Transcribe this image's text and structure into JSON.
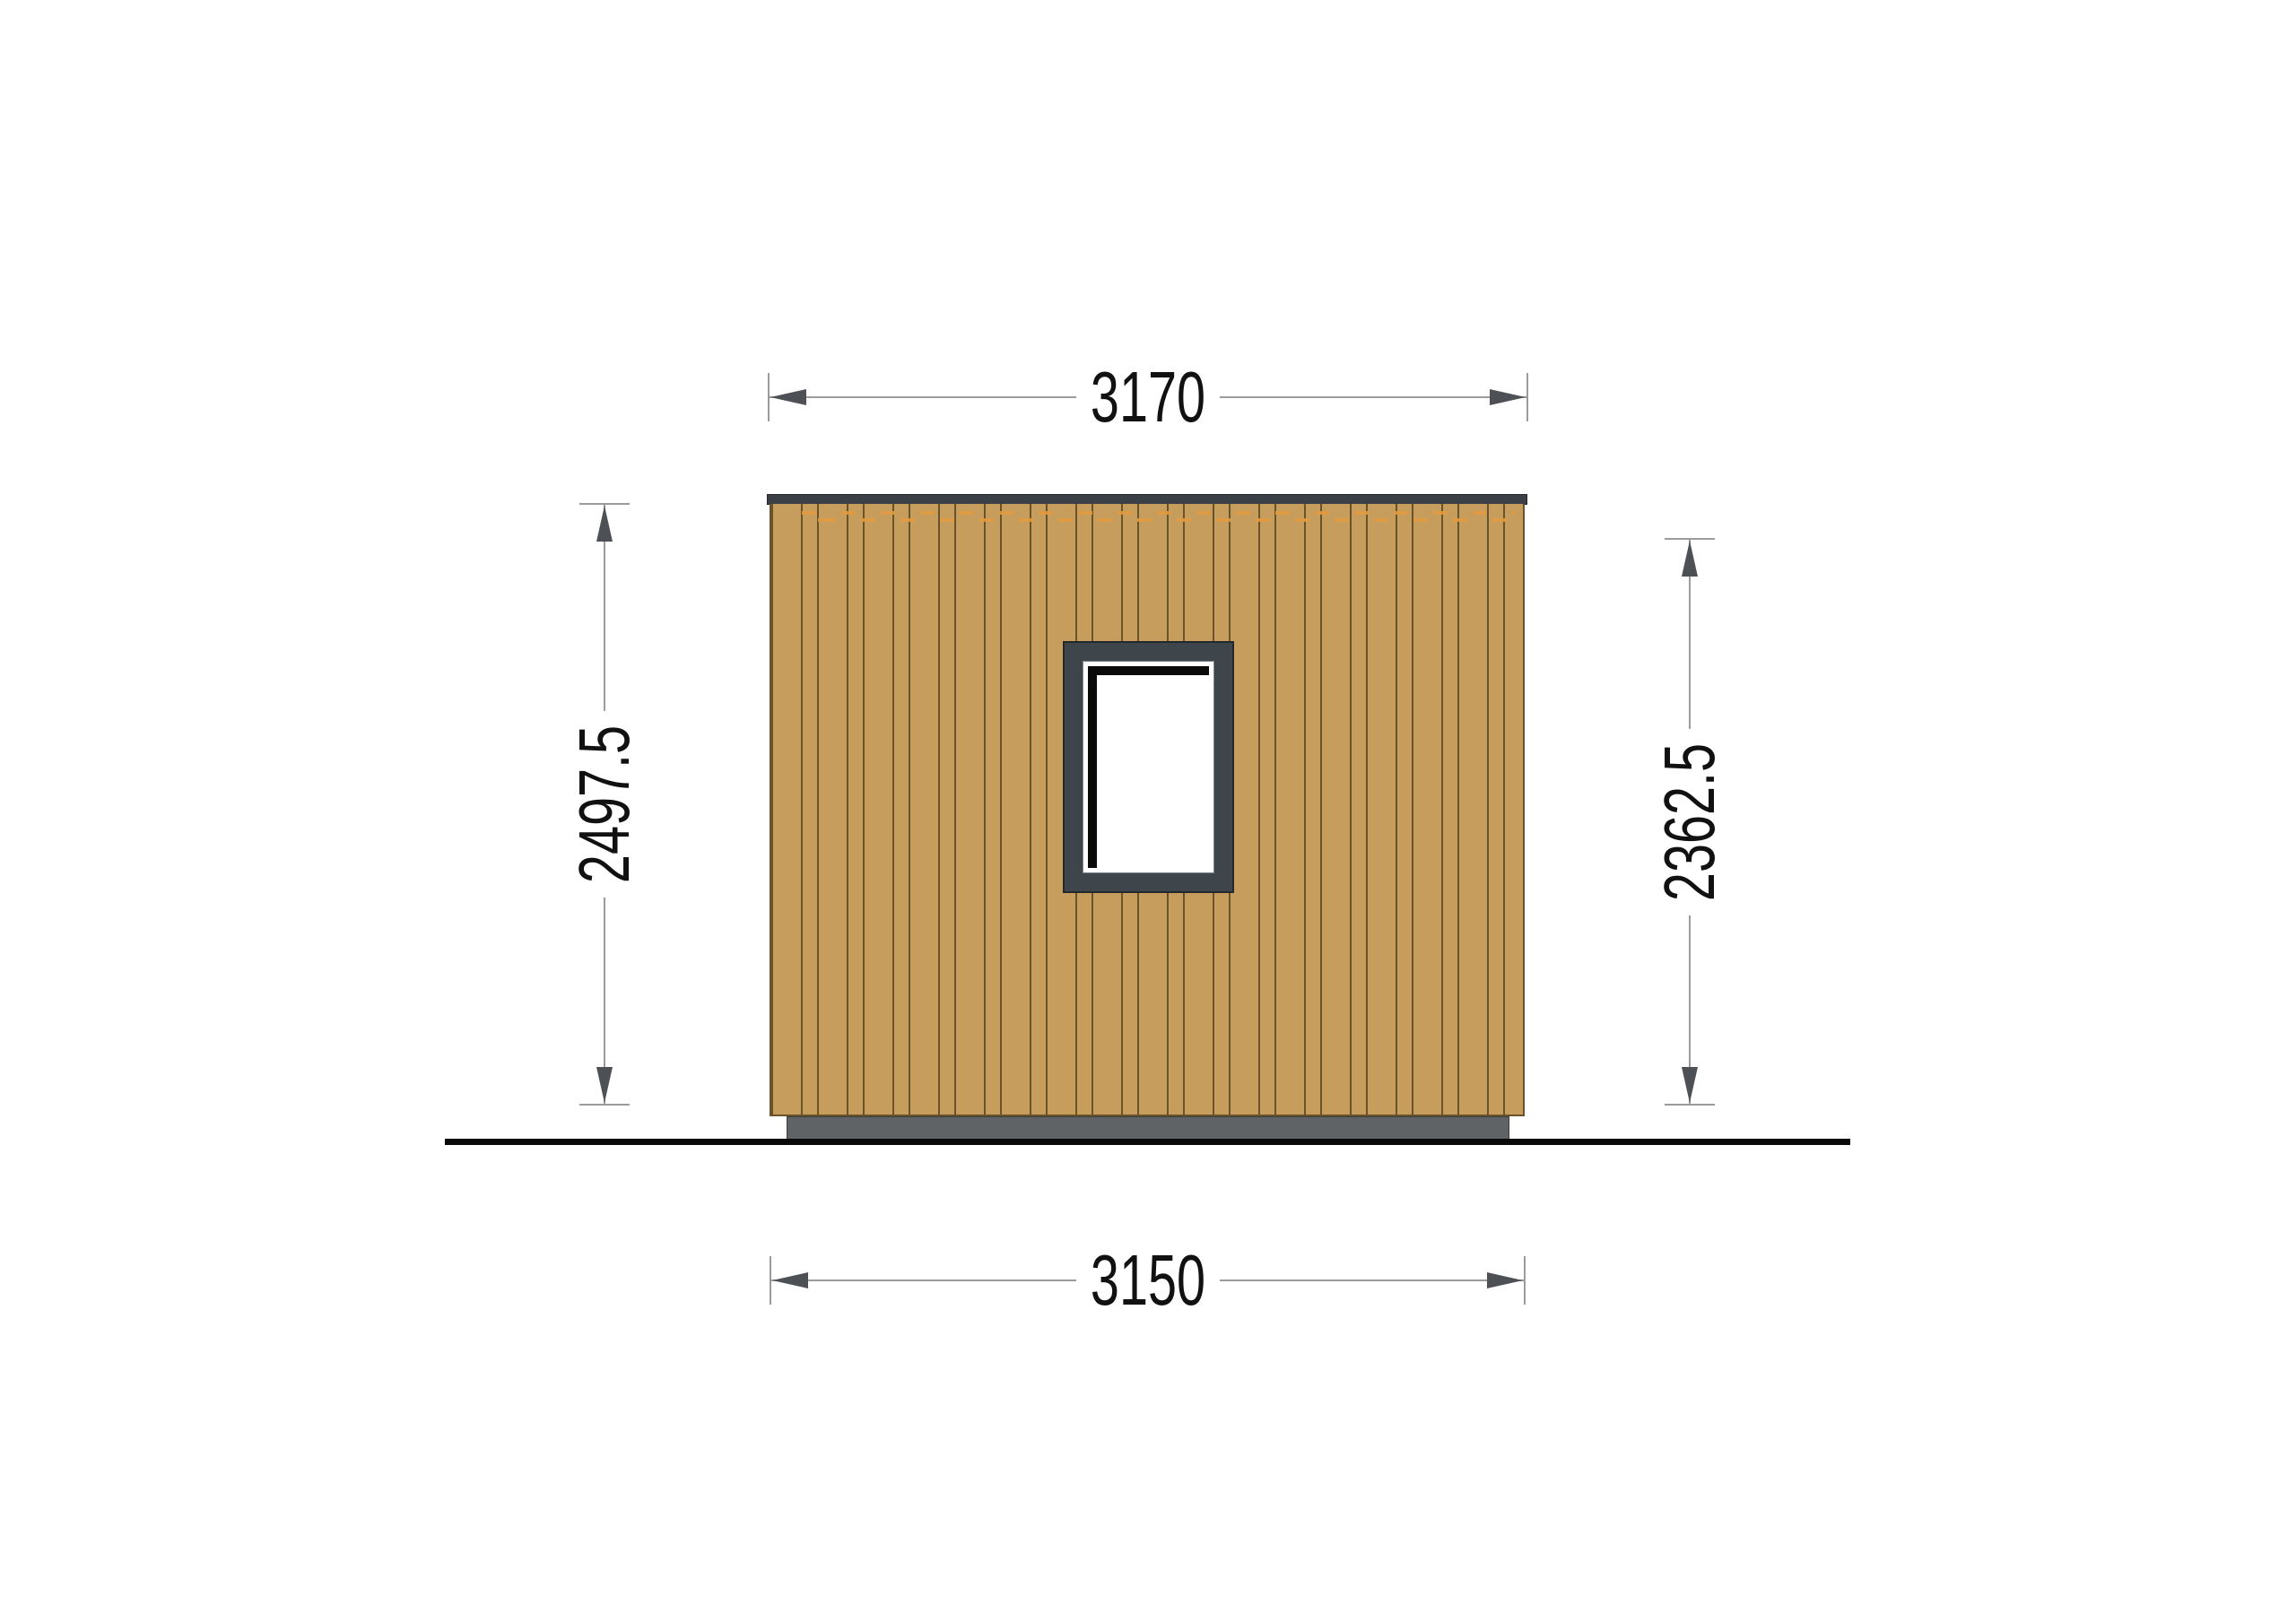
{
  "dimensions": {
    "top_width": "3170",
    "bottom_width": "3150",
    "left_height": "2497.5",
    "right_height": "2362.5"
  },
  "colors": {
    "wood": "#C79D5E",
    "wood_line": "#6A5328",
    "roof": "#3A4045",
    "plinth": "#5F6366",
    "plinth_line": "#3C3F42",
    "window_frame": "#3E464C",
    "window_outline": "#23282C",
    "window_shadow": "#0A0A0A",
    "accent_dashes": "#E09B40",
    "dim_line": "#9B9B9B",
    "dim_arrow": "#4D5156",
    "dim_text": "#111111",
    "ground": "#0A0A0A",
    "background": "#FFFFFF"
  }
}
